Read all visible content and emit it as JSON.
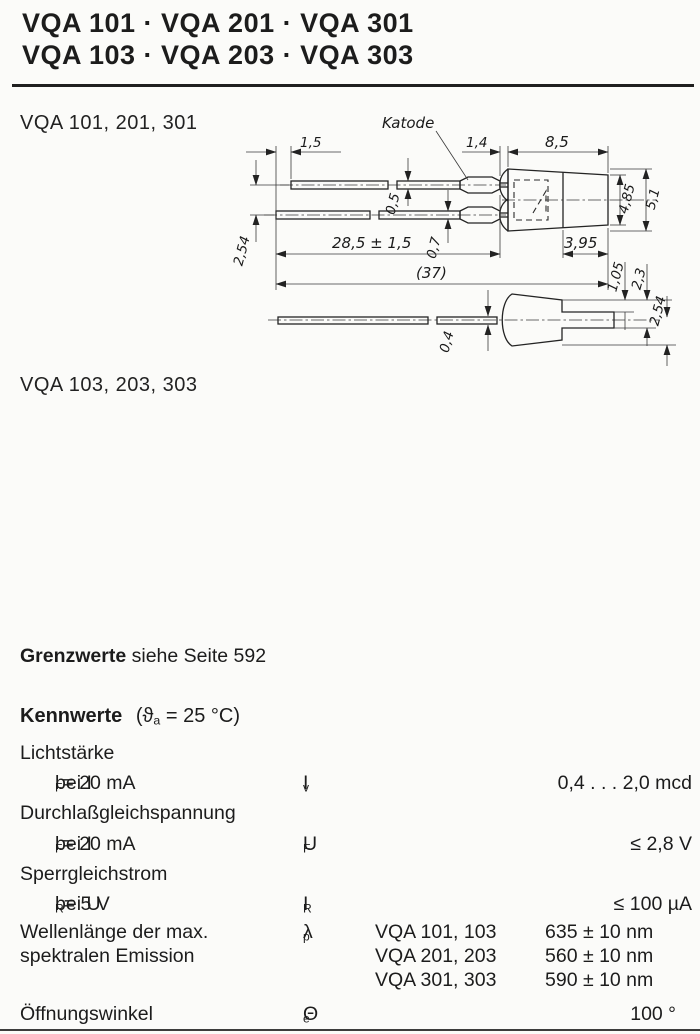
{
  "colors": {
    "paper": "#fbfbf9",
    "ink": "#1c1c1c"
  },
  "header": {
    "line1": "VQA 101 · VQA 201 · VQA 301",
    "line2": "VQA 103 · VQA 203 · VQA 303"
  },
  "drawing1": {
    "title": "VQA 101, 201, 301",
    "katode": "Katode",
    "dims": {
      "lead_offset": "1,5",
      "lip": "1,4",
      "body_len": "8,5",
      "pitch": "2,54",
      "lead1_thk": "0,5",
      "lead2_thk": "0,7",
      "lead_len": "28,5 ± 1,5",
      "total": "(37)",
      "tip_len": "3,95",
      "body_h_tip": "4,85",
      "body_h": "5,1",
      "side_a": "1,05",
      "side_b": "2,3",
      "side_lead_thk": "0,4",
      "side_c": "2,54"
    }
  },
  "drawing2": {
    "title": "VQA 103, 203, 303",
    "katode": "Katode",
    "dims": {
      "lead_offset": "(2)",
      "lead1_len": "17,5",
      "crimp": "1,7 max.",
      "body_len": "8,5",
      "pitch": "2,54",
      "lead2_thk": "0,5",
      "lead2_len": "19,5",
      "lip": "1,4 max.",
      "front_len": "12,3",
      "tip_len": "3,95",
      "total": "(31,8)",
      "body_h_tip": "4,85",
      "body_h": "5,1 max.",
      "side_lead_thk": "0,5",
      "side_a": "1,05",
      "side_b": "2,3",
      "side_c": "2,54 max."
    }
  },
  "grenzwerte": {
    "bold": "Grenzwerte",
    "rest": "siehe Seite 592"
  },
  "kennwerte": {
    "heading": "Kennwerte",
    "cond_pre": "(ϑ",
    "cond_sub": "a",
    "cond_post": " = 25 °C)",
    "params": {
      "lichtstaerke": {
        "name": "Lichtstärke",
        "cond_pre": "bei I",
        "cond_sub": "F",
        "cond_post": " = 20 mA",
        "sym": "I",
        "sym_sub": "v",
        "value": "0,4 . . . 2,0 mcd"
      },
      "durchlass": {
        "name": "Durchlaßgleichspannung",
        "cond_pre": "bei I",
        "cond_sub": "F",
        "cond_post": " = 20 mA",
        "sym": "U",
        "sym_sub": "F",
        "value": "≤ 2,8 V"
      },
      "sperr": {
        "name": "Sperrgleichstrom",
        "cond_pre": "bei U",
        "cond_sub": "R",
        "cond_post": " = 5 V",
        "sym": "I",
        "sym_sub": "R",
        "value": "≤ 100 µA"
      },
      "wellenlaenge": {
        "name_line1": "Wellenlänge der max.",
        "name_line2": "spektralen Emission",
        "sym": "λ",
        "sym_sub": "p",
        "variants": [
          {
            "types": "VQA 101, 103",
            "value": "635 ± 10 nm"
          },
          {
            "types": "VQA 201, 203",
            "value": "560 ± 10 nm"
          },
          {
            "types": "VQA 301, 303",
            "value": "590 ± 10 nm"
          }
        ]
      },
      "oeffnungswinkel": {
        "name": "Öffnungswinkel",
        "sym": "Θ",
        "sym_sub": "e",
        "value": "100 °"
      }
    }
  }
}
